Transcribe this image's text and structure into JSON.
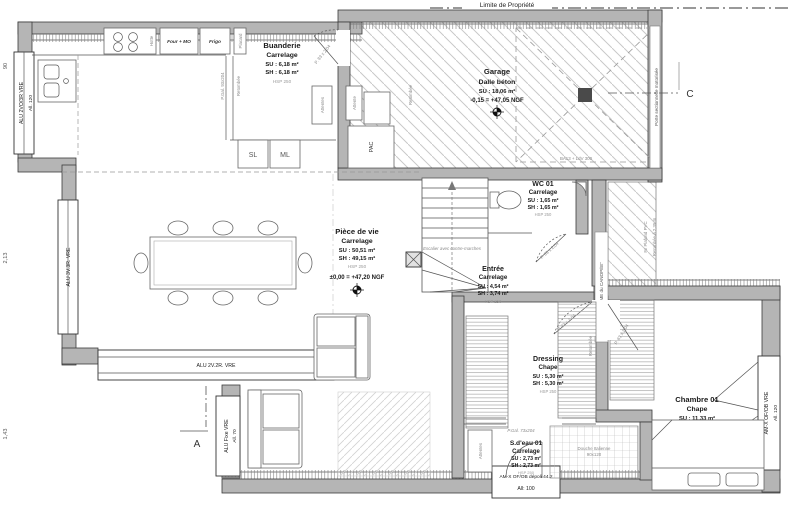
{
  "plan": {
    "property_line": "Limite de Propriété",
    "section_a": "A",
    "section_c": "C"
  },
  "rooms": {
    "buanderie": {
      "name": "Buanderie",
      "finish": "Carrelage",
      "su": "SU : 6,18 m²",
      "sh": "SH : 6,18 m²",
      "hsp": "HSP 250"
    },
    "garage": {
      "name": "Garage",
      "finish": "Dalle béton",
      "su": "SU : 18,06 m²",
      "level": "-0,15 = +47,05 NGF"
    },
    "wc": {
      "name": "WC 01",
      "finish": "Carrelage",
      "su": "SU : 1,65 m²",
      "sh": "SH : 1,65 m²",
      "hsp": "HSP 250"
    },
    "piece_de_vie": {
      "name": "Pièce de vie",
      "finish": "Carrelage",
      "su": "SU : 50,51 m²",
      "sh": "SH : 49,15 m²",
      "hsp": "HSP 250",
      "level": "±0,00 = +47,20 NGF"
    },
    "entree": {
      "name": "Entrée",
      "finish": "Carrelage",
      "su": "SU : 4,54 m²",
      "sh": "SH : 3,74 m²",
      "hsp": "HSP 250"
    },
    "dressing": {
      "name": "Dressing",
      "finish": "Chape",
      "su": "SU : 5,30 m²",
      "sh": "SH : 5,30 m²",
      "hsp": "HSP 250"
    },
    "chambre": {
      "name": "Chambre 01",
      "finish": "Chape",
      "su": "SU : 11,33 m²",
      "sh": "SH : 11,33 m²",
      "hsp": "HSP 250"
    },
    "sdeau": {
      "name": "S.d'eau 01",
      "finish": "Carrelage",
      "su": "SU : 2,73 m²",
      "sh": "SH : 2,73 m²",
      "hsp": "HSP 250"
    }
  },
  "windows": {
    "left_top": {
      "label": "ALU 2VO/3R VRE",
      "sill": "All. 120"
    },
    "left_mid": {
      "label": "ALU 3V.3R. VRE"
    },
    "bottom_left": {
      "label": "ALU 2V.2R. VRE"
    },
    "bay": {
      "label": "ALU Fixe VRE",
      "sill": "All. 70"
    },
    "right": {
      "label": "AM-X OF/OB VRE",
      "sill": "All. 120"
    },
    "bottom_center": {
      "label": "AM-X OF/OB dépoli 44.2",
      "sill": "All: 100"
    }
  },
  "doors": {
    "p83": "P. 83 x 2,04",
    "pgal73": "P.Gal. 73x204",
    "pgal93": "P.Gal. 93x204",
    "sectional": "Porte sectionnelle motorisée"
  },
  "kitchen": {
    "four": "Four + MO",
    "frigo": "Frigo",
    "placard": "Placard",
    "hotte": "Hotte",
    "sl": "SL",
    "ml": "ML"
  },
  "equipment": {
    "pac": "PAC",
    "attente": "Attente",
    "attentes": "Attentes",
    "douche_l1": "Douche Italienne",
    "douche_l2": "90x120"
  },
  "annotations": {
    "stairs": "Escalier avec contre-marches",
    "brume": "\"BRUME du CANOPÉE\"",
    "fx_plafond": "Fx Plafond PVC",
    "retombee_235": "Retombée à 2,35 m",
    "retombee": "Retombée",
    "ba13": "BA13 + LdV 300"
  },
  "dimensions": {
    "d1": "90",
    "d2": "2,13",
    "d3": "1,43"
  }
}
